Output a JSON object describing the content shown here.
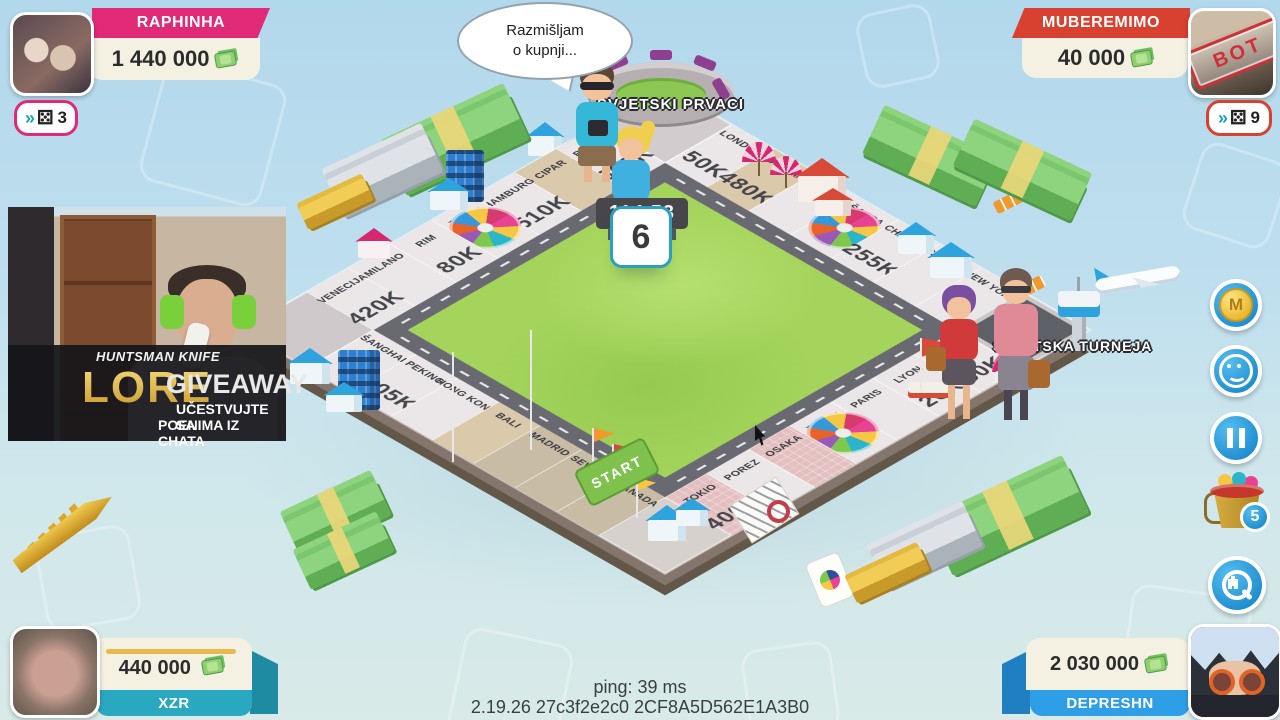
{
  "players": {
    "top_left": {
      "name": "RAPHINHA",
      "money": "1 440 000",
      "dice_count": "3",
      "accent": "#e02a78"
    },
    "top_right": {
      "name": "MUBEREMIMO",
      "money": "40 000",
      "dice_count": "9",
      "accent": "#d8402f",
      "stamp": "BOT"
    },
    "bottom_left": {
      "name": "XZR",
      "money": "440 000",
      "accent": "#2aa8c0"
    },
    "bottom_right": {
      "name": "DEPRESHN",
      "money": "2 030 000",
      "accent": "#2e9fe6"
    }
  },
  "speech_bubble": {
    "line1": "Razmišljam",
    "line2": "o kupnji..."
  },
  "hud": {
    "timer": "114.53",
    "dice_value": "6",
    "ping": "ping: 39 ms",
    "version": "2.19.26 27c3f2e2c0 2CF8A5D562E1A3B0"
  },
  "corners": {
    "top": "SVJETSKI PRVACI",
    "right": "SVJETSKA TURNEJA",
    "bottom_label": "START"
  },
  "board": {
    "edges": {
      "top": [
        {
          "name": "LONDON",
          "price": "50K"
        },
        {
          "name": "DUBAI",
          "price": "480K",
          "color": "sand"
        },
        {
          "name": "SYDNEY"
        },
        {
          "name": "ŠANSA",
          "wheel": true
        },
        {
          "name": "CHICAGO",
          "price": "255K"
        },
        {
          "name": "LAS VEGAS"
        },
        {
          "name": "NEW YORK"
        }
      ],
      "right": [
        {
          "name": "NICE",
          "price": "50K"
        },
        {
          "name": "LYON",
          "price": "26K"
        },
        {
          "name": "PARIS"
        },
        {
          "name": "ŠANSA",
          "wheel": true
        },
        {
          "name": "OSAKA",
          "color": "brick"
        },
        {
          "name": "POREZ"
        },
        {
          "name": "TOKIO",
          "price": "400K",
          "color": "brick"
        }
      ],
      "bottom": [
        {
          "name": "ŠANGHAI"
        },
        {
          "name": "PEKING",
          "price": "105K"
        },
        {
          "name": "HONG KONG"
        },
        {
          "name": "BALI",
          "color": "sand"
        },
        {
          "name": "MADRID",
          "color": "stone"
        },
        {
          "name": "SEVILJA",
          "color": "stone"
        },
        {
          "name": "GRANADA",
          "color": "stone"
        }
      ],
      "left": [
        {
          "name": "BERLIN",
          "price": "360K"
        },
        {
          "name": "CIPAR",
          "color": "sand"
        },
        {
          "name": "HAMBURG",
          "price": "510K"
        },
        {
          "name": "ŠANSA",
          "wheel": true
        },
        {
          "name": "RIM",
          "price": "80K"
        },
        {
          "name": "MILANO"
        },
        {
          "name": "VENECIJA",
          "price": "420K"
        }
      ]
    }
  },
  "sidebar": {
    "buttons": [
      "coin",
      "smiley",
      "pause",
      "bucket",
      "zoom"
    ],
    "bucket_badge": "5",
    "coin_letter": "M"
  },
  "icons": {
    "die": "⚄",
    "fast_forward": "››"
  },
  "overlay": {
    "line_top": "HUNTSMAN KNIFE",
    "word_gold": "LORE",
    "word_big": "GIVEAWAY",
    "line1": "UČESTVUJTE SA",
    "line2": "POENIMA IZ CHATA"
  }
}
